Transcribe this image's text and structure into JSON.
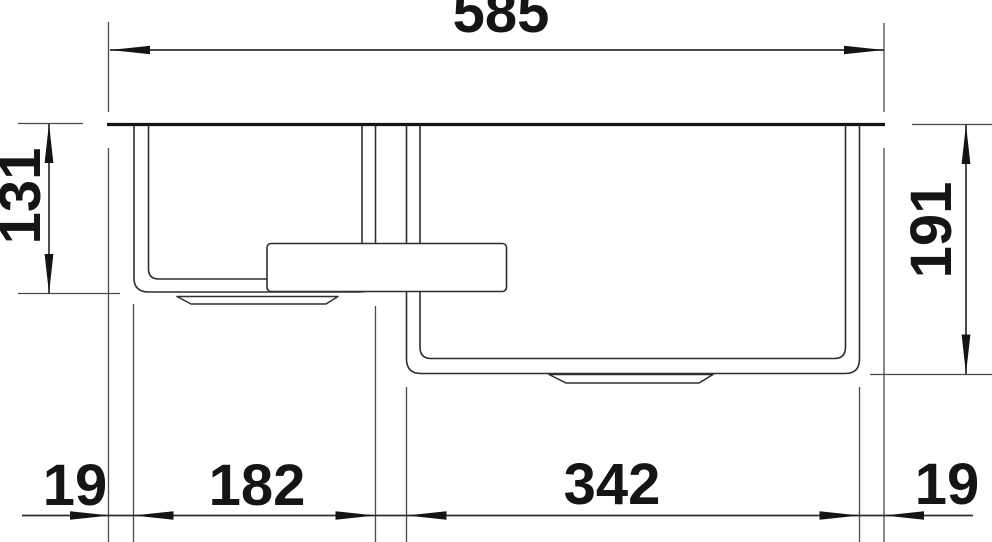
{
  "drawing": {
    "type": "sink-top-view-dimension-drawing",
    "dimensions": {
      "total_width": "585",
      "left_bowl_depth": "131",
      "right_bowl_depth": "191",
      "bottom_left_edge": "19",
      "left_bowl_width": "182",
      "right_bowl_width": "342",
      "bottom_right_edge": "19"
    },
    "colors": {
      "background": "#ffffff",
      "line": "#2e2e2e",
      "heavy_line": "#141414",
      "label": "#151515"
    }
  }
}
